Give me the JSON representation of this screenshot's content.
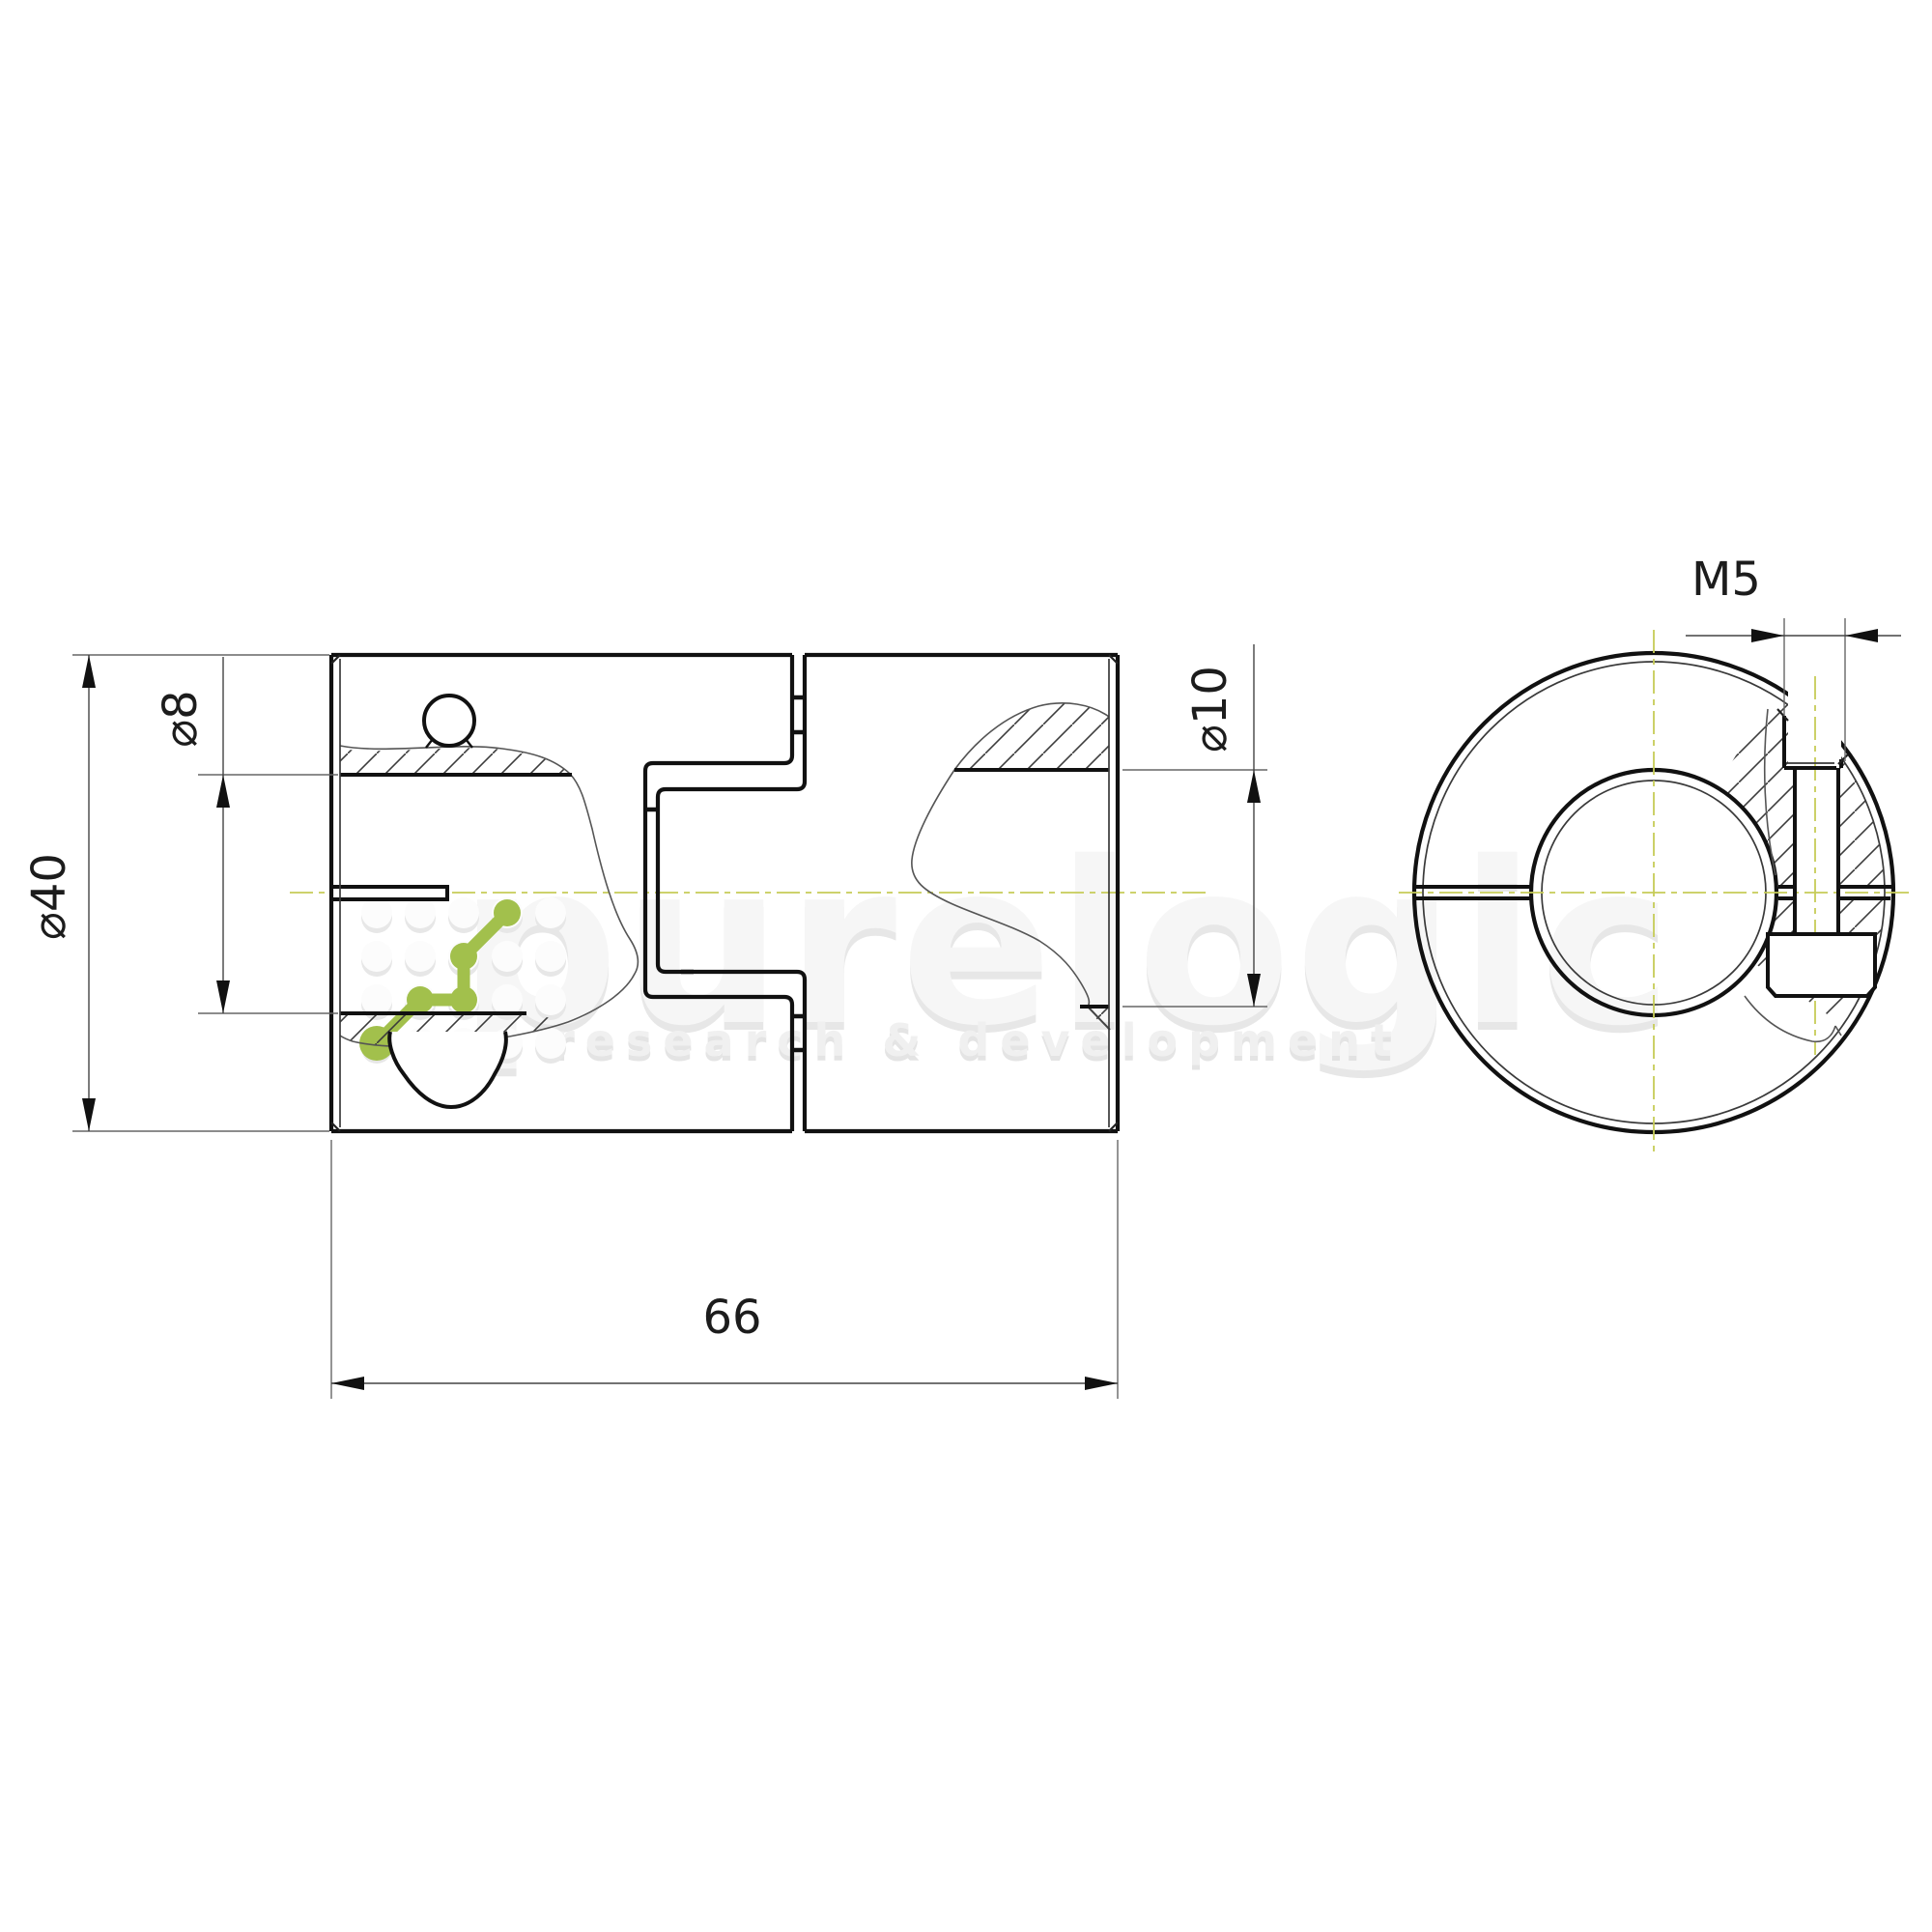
{
  "drawing": {
    "dim_outer_diameter": "⌀40",
    "dim_left_bore": "⌀8",
    "dim_right_bore": "⌀10",
    "dim_length": "66",
    "dim_thread": "M5"
  },
  "watermark": {
    "brand": "purelogic",
    "tagline": "research & development"
  },
  "colors": {
    "line": "#111111",
    "thin_line": "#555555",
    "centerline": "#c6cc58",
    "accent_green": "#a2c04c",
    "watermark_gray": "#ededed"
  }
}
